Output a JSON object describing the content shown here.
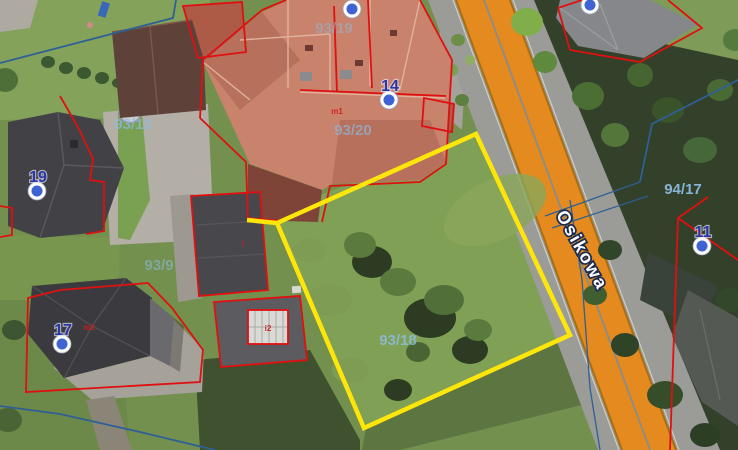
{
  "map": {
    "street": {
      "name": "Osikowa",
      "x": 577,
      "y": 253,
      "angle_deg": 61
    },
    "selected_parcel": {
      "label": "93/18"
    },
    "parcel_labels": [
      {
        "text": "93/13",
        "x": 133,
        "y": 129,
        "opacity": 0.7
      },
      {
        "text": "93/19",
        "x": 334,
        "y": 33,
        "opacity": 0.5
      },
      {
        "text": "93/20",
        "x": 353,
        "y": 135,
        "opacity": 0.65
      },
      {
        "text": "93/18",
        "x": 398,
        "y": 345,
        "opacity": 0.85
      },
      {
        "text": "93/9",
        "x": 159,
        "y": 270,
        "opacity": 0.55
      },
      {
        "text": "94/17",
        "x": 683,
        "y": 194,
        "opacity": 0.95
      }
    ],
    "markers": [
      {
        "label": "19",
        "cx": 37,
        "cy": 191
      },
      {
        "label": "17",
        "cx": 62,
        "cy": 344
      },
      {
        "label": "14",
        "cx": 389,
        "cy": 100
      },
      {
        "label": "11",
        "cx": 702,
        "cy": 246
      },
      {
        "label": "",
        "cx": 352,
        "cy": 9
      },
      {
        "label": "",
        "cx": 590,
        "cy": 5
      }
    ],
    "building_labels": [
      {
        "text": "m1",
        "x": 337,
        "y": 114
      },
      {
        "text": "i",
        "x": 243,
        "y": 246
      },
      {
        "text": "i2",
        "x": 268,
        "y": 331
      },
      {
        "text": "m2",
        "x": 89,
        "y": 330
      }
    ],
    "colors": {
      "selected_parcel_outline": "#ffe60a",
      "parcel_outline_red": "#e01010",
      "cadastral_blue": "#2e6095",
      "road_band_orange": "#e58a1e",
      "road_band_border": "#a96e12",
      "marker_blue": "#3f63d2",
      "parcel_label_blue": "#8cbbe0"
    }
  }
}
